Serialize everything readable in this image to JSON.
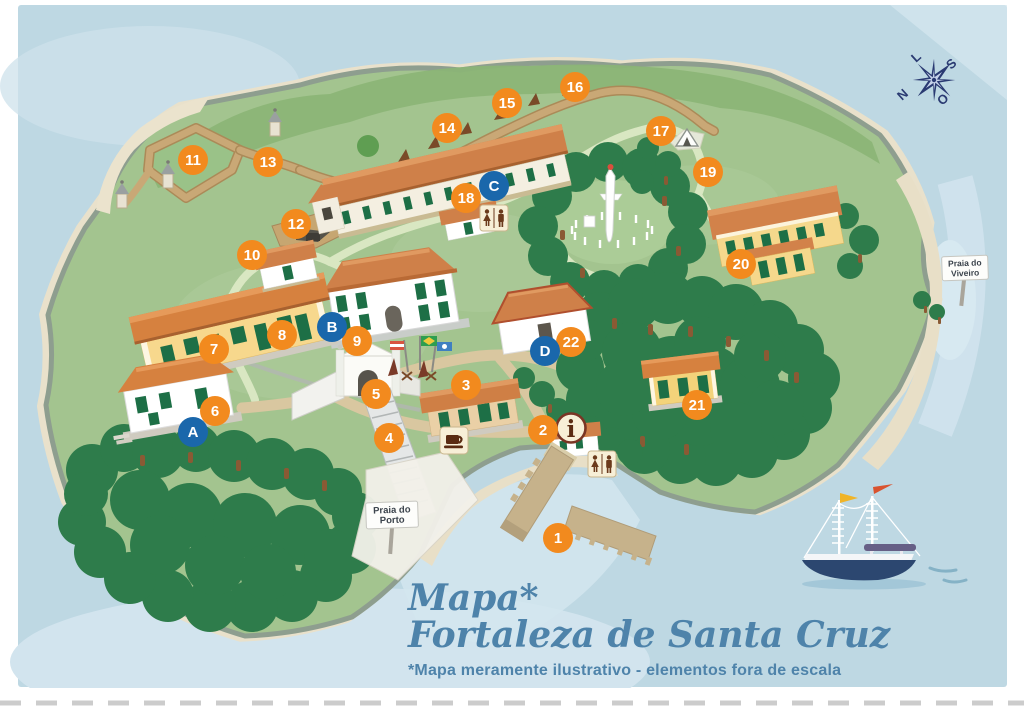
{
  "map": {
    "title_line1": "Mapa*",
    "title_line2": "Fortaleza de Santa Cruz",
    "disclaimer": "*Mapa meramente ilustrativo - elementos fora de escala",
    "info_letter": "i",
    "signs": [
      {
        "id": "praia-do-porto",
        "line1": "Praia do",
        "line2": "Porto"
      },
      {
        "id": "praia-do-viveiro",
        "line1": "Praia do",
        "line2": "Viveiro"
      }
    ],
    "compass": {
      "north": "N",
      "south": "S",
      "east": "L",
      "west": "O"
    },
    "markers": {
      "numbered": [
        {
          "label": "1",
          "x": 558,
          "y": 538
        },
        {
          "label": "2",
          "x": 543,
          "y": 430
        },
        {
          "label": "3",
          "x": 466,
          "y": 385
        },
        {
          "label": "4",
          "x": 389,
          "y": 438
        },
        {
          "label": "5",
          "x": 376,
          "y": 394
        },
        {
          "label": "6",
          "x": 215,
          "y": 411
        },
        {
          "label": "7",
          "x": 214,
          "y": 349
        },
        {
          "label": "8",
          "x": 282,
          "y": 335
        },
        {
          "label": "9",
          "x": 357,
          "y": 341
        },
        {
          "label": "10",
          "x": 252,
          "y": 255
        },
        {
          "label": "11",
          "x": 193,
          "y": 160
        },
        {
          "label": "12",
          "x": 296,
          "y": 224
        },
        {
          "label": "13",
          "x": 268,
          "y": 162
        },
        {
          "label": "14",
          "x": 447,
          "y": 128
        },
        {
          "label": "15",
          "x": 507,
          "y": 103
        },
        {
          "label": "16",
          "x": 575,
          "y": 87
        },
        {
          "label": "17",
          "x": 661,
          "y": 131
        },
        {
          "label": "18",
          "x": 466,
          "y": 198
        },
        {
          "label": "19",
          "x": 708,
          "y": 172
        },
        {
          "label": "20",
          "x": 741,
          "y": 264
        },
        {
          "label": "21",
          "x": 697,
          "y": 405
        },
        {
          "label": "22",
          "x": 571,
          "y": 342
        }
      ],
      "lettered": [
        {
          "label": "A",
          "x": 193,
          "y": 432
        },
        {
          "label": "B",
          "x": 332,
          "y": 327
        },
        {
          "label": "C",
          "x": 494,
          "y": 186
        },
        {
          "label": "D",
          "x": 545,
          "y": 351
        }
      ]
    },
    "amenity_icons": [
      {
        "name": "restroom-icon",
        "x": 494,
        "y": 218
      },
      {
        "name": "restroom-icon",
        "x": 602,
        "y": 464
      },
      {
        "name": "info-icon",
        "x": 571,
        "y": 428
      },
      {
        "name": "coffee-icon",
        "x": 454,
        "y": 441
      },
      {
        "name": "tent-icon",
        "x": 684,
        "y": 136
      }
    ],
    "colors": {
      "marker_orange": "#f28a1e",
      "marker_blue": "#1a67ab",
      "water": "#bed8e3",
      "island_green": "#a3c48f",
      "forest_green": "#2e7c4b",
      "roof_orange": "#cf8049",
      "wall_tan": "#c9a876",
      "title_blue": "#4e83aa",
      "icon_cream": "#f7efd7",
      "icon_brown": "#6b3a1c"
    }
  }
}
